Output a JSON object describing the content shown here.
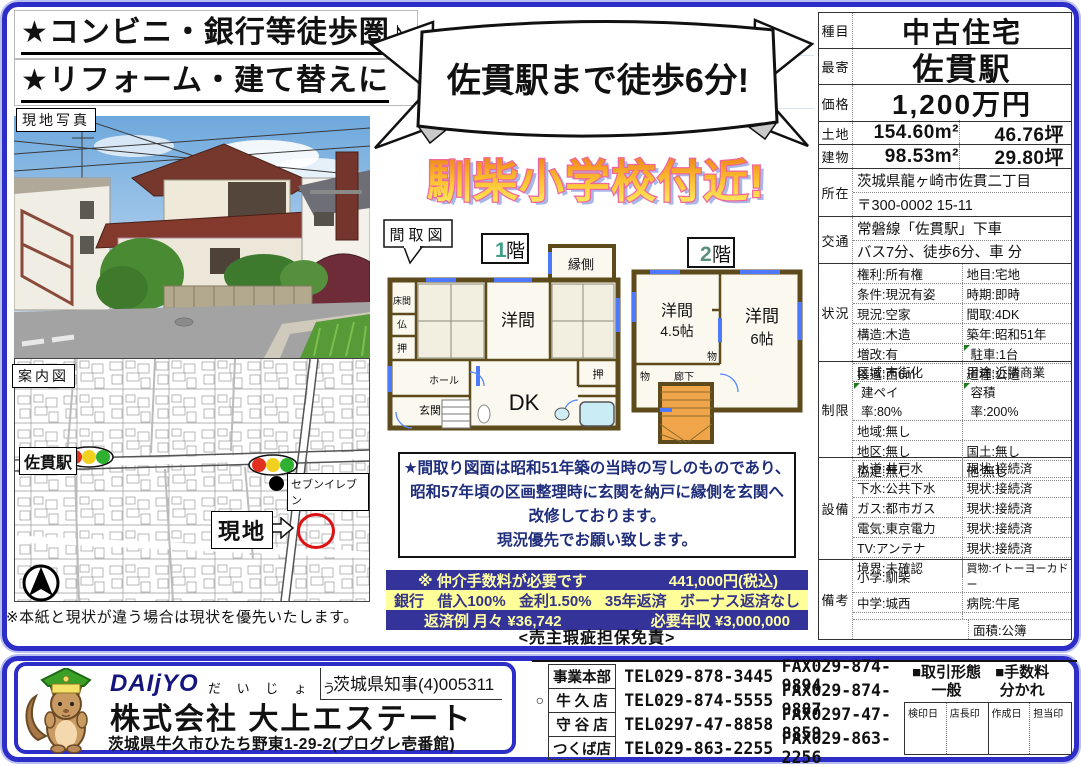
{
  "colors": {
    "frame_blue": "#2d2dc8",
    "frame_halo": "#b9bef0",
    "navy_band_bg": "#333399",
    "navy_band_text": "#ffffa6",
    "yellow_band_bg": "#ffff99",
    "headline_outline": "#f0679e",
    "headline_fill_top": "#ee8418",
    "headline_fill_bottom": "#ffef66",
    "note_text": "#1f2d7a",
    "wall_brown": "#5d4b1c",
    "window_blue": "#4d79ff",
    "stairs_orange": "#f0a54a",
    "site_circle_red": "#dd1111"
  },
  "banners": {
    "line1": "★コンビニ・銀行等徒歩圏♪",
    "line2": "★リフォーム・建て替えに"
  },
  "photo": {
    "label": "現地写真"
  },
  "map": {
    "label": "案内図",
    "station": "佐貫駅",
    "store": "セブンイレブン",
    "site": "現地",
    "disclaimer": "※本紙と現状が違う場合は現状を優先いたします。"
  },
  "ribbon": {
    "text": "佐貫駅まで徒歩6分!"
  },
  "headline": {
    "text": "馴柴小学校付近!"
  },
  "floorplan": {
    "label": "間取図",
    "f1": {
      "title_num": "1",
      "title_kai": "階",
      "rooms": {
        "engawa": "縁側",
        "tokonoma": "床間",
        "butsu": "仏",
        "oshi_left": "押",
        "yoma": "洋間",
        "oshi_right": "押",
        "hall": "ホール",
        "genkan": "玄関",
        "dk": "DK",
        "oshi_bottom": "押"
      }
    },
    "f2": {
      "title_num": "2",
      "title_kai": "階",
      "rooms": {
        "yoma45a": "洋間",
        "yoma45b": "4.5帖",
        "yoma6a": "洋間",
        "yoma6b": "6帖",
        "mono_right": "物",
        "mono_left": "物",
        "rouka": "廊下"
      }
    },
    "note_lines": [
      "★間取り図面は昭和51年築の当時の写しのものであり、",
      "昭和57年頃の区画整理時に玄関を納戸に縁側を玄関へ",
      "改修しております。",
      "現況優先でお願い致します。"
    ]
  },
  "loan": {
    "row1_left": "※ 仲介手数料が必要です",
    "row1_right": "441,000円(税込)",
    "row2_items": [
      "銀行",
      "借入100%",
      "金利1.50%",
      "35年返済",
      "ボーナス返済なし"
    ],
    "row3_left": "返済例  月々 ¥36,742",
    "row3_right": "必要年収 ¥3,000,000",
    "seller_note": "<売主瑕疵担保免責>"
  },
  "spec": {
    "shumoku_label": "種目",
    "shumoku": "中古住宅",
    "moyori_label": "最寄",
    "moyori": "佐貫駅",
    "kakaku_label": "価格",
    "kakaku": "1,200万円",
    "tochi_label": "土地",
    "tochi_m2": "154.60m²",
    "tochi_tsubo": "46.76坪",
    "tatemono_label": "建物",
    "tatemono_m2": "98.53m²",
    "tatemono_tsubo": "29.80坪",
    "shozai_label": "所在",
    "shozai1": "茨城県龍ヶ崎市佐貫二丁目",
    "shozai2": "〒300-0002  15-11",
    "kotsu_label": "交通",
    "kotsu1": "常磐線「佐貫駅」下車",
    "kotsu2": "バス7分、徒歩6分、車  分",
    "jokyo_label": "状況",
    "jokyo": [
      [
        "権利:所有権",
        "地目:宅地"
      ],
      [
        "条件:現況有姿",
        "時期:即時"
      ],
      [
        "現況:空家",
        "間取:4DK"
      ],
      [
        "構造:木造",
        "築年:昭和51年"
      ],
      [
        "増改:有",
        "駐車:1台"
      ],
      [
        "接道:西6m",
        "道種:公道"
      ]
    ],
    "seigen_label": "制限",
    "seigen": [
      [
        "区域:市街化",
        "用途:近隣商業"
      ],
      [
        "建ペイ率:80%",
        "容積率:200%"
      ],
      [
        "地域:無し",
        ""
      ],
      [
        "地区:無し",
        "国土:無し"
      ],
      [
        "協定:無し",
        "他:無し"
      ]
    ],
    "setsubi_label": "設備",
    "setsubi": [
      [
        "水道:井戸水",
        "現状:接続済"
      ],
      [
        "下水:公共下水",
        "現状:接続済"
      ],
      [
        "ガス:都市ガス",
        "現状:接続済"
      ],
      [
        "電気:東京電力",
        "現状:接続済"
      ],
      [
        "TV:アンテナ",
        "現状:接続済"
      ],
      [
        "境界:未確認",
        ""
      ]
    ],
    "biko_label": "備考",
    "biko": [
      [
        "小学:馴柴",
        "買物:イトーヨーカドー"
      ],
      [
        "中学:城西",
        "病院:牛尾"
      ]
    ],
    "menseki": "面積:公簿"
  },
  "footer": {
    "logo_text": "DAIjYO",
    "logo_kana": "だ い じ ょ う",
    "license": "茨城県知事(4)005311",
    "company": "株式会社 大上エステート",
    "address": "茨城県牛久市ひたち野東1-29-2(プログレ壱番館)",
    "offices": [
      {
        "mark": "",
        "name": "事業本部",
        "tel": "TEL029-878-3445",
        "fax": "FAX029-874-9894"
      },
      {
        "mark": "○",
        "name": "牛 久 店",
        "tel": "TEL029-874-5555",
        "fax": "FAX029-874-9887"
      },
      {
        "mark": "",
        "name": "守 谷 店",
        "tel": "TEL0297-47-8858",
        "fax": "FAX0297-47-8859"
      },
      {
        "mark": "",
        "name": "つくば店",
        "tel": "TEL029-863-2255",
        "fax": "FAX029-863-2256"
      }
    ],
    "deal_type_label": "■取引形態",
    "deal_type": "一般",
    "fee_label": "■手数料",
    "fee": "分かれ",
    "stamps": [
      "検印日",
      "店長印",
      "作成日",
      "担当印"
    ]
  }
}
